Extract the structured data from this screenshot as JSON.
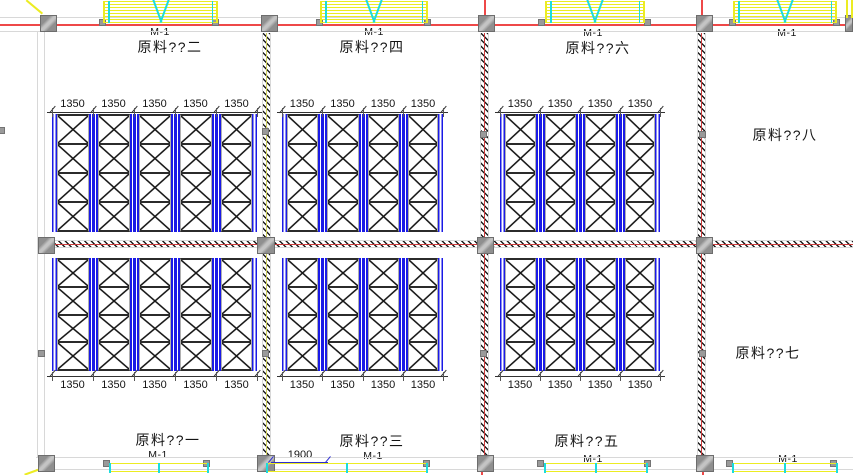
{
  "drawing": {
    "type": "cad-warehouse-rack-floor-plan",
    "door_tag": "M-1",
    "bay_dimension": "1350",
    "door_width_dimension": "1900"
  },
  "rooms": {
    "top_left": "原料??二",
    "top_middle": "原料??四",
    "top_right": "原料??六",
    "upper_right": "原料??八",
    "bottom_left": "原料??一",
    "bottom_middle": "原料??三",
    "bottom_right": "原料??五",
    "lower_right": "原料??七"
  },
  "door_tags": {
    "top": [
      "M-1",
      "M-1",
      "M-1",
      "M-1"
    ],
    "bottom": [
      "M-1",
      "M-1",
      "M-1",
      "M-1"
    ]
  },
  "dimensions": {
    "door_width": {
      "value": "1900"
    }
  },
  "rack_blocks": [
    {
      "name": "upper-left",
      "bays": 5,
      "rows": 4,
      "bay_width_mm": "1350",
      "dim_side": "top",
      "dim_labels": [
        "1350",
        "1350",
        "1350",
        "1350",
        "1350"
      ]
    },
    {
      "name": "upper-middle",
      "bays": 4,
      "rows": 4,
      "bay_width_mm": "1350",
      "dim_side": "top",
      "dim_labels": [
        "1350",
        "1350",
        "1350",
        "1350"
      ]
    },
    {
      "name": "upper-right",
      "bays": 4,
      "rows": 4,
      "bay_width_mm": "1350",
      "dim_side": "top",
      "dim_labels": [
        "1350",
        "1350",
        "1350",
        "1350"
      ]
    },
    {
      "name": "lower-left",
      "bays": 5,
      "rows": 4,
      "bay_width_mm": "1350",
      "dim_side": "bottom",
      "dim_labels": [
        "1350",
        "1350",
        "1350",
        "1350",
        "1350"
      ]
    },
    {
      "name": "lower-middle",
      "bays": 4,
      "rows": 4,
      "bay_width_mm": "1350",
      "dim_side": "bottom",
      "dim_labels": [
        "1350",
        "1350",
        "1350",
        "1350"
      ]
    },
    {
      "name": "lower-right",
      "bays": 4,
      "rows": 4,
      "bay_width_mm": "1350",
      "dim_side": "bottom",
      "dim_labels": [
        "1350",
        "1350",
        "1350",
        "1350"
      ]
    }
  ],
  "colors": {
    "rack_post_blue": "#1a1ae6",
    "brace_black": "#161616",
    "shelf_dark": "#2b2b2b",
    "wall_line_gray": "#d8d8d8",
    "wall_red": "#ee4848",
    "hatch_core_red": "#c93a3a",
    "hatch_core_yellow": "#cfcf5e",
    "hatch_black": "#1c1c1c",
    "column_gray": "#8f8f8f",
    "door_yellow": "#ecec22",
    "door_cyan": "#1cdcdc",
    "dim_blue": "#2d2dd0",
    "text_black": "#141414"
  }
}
